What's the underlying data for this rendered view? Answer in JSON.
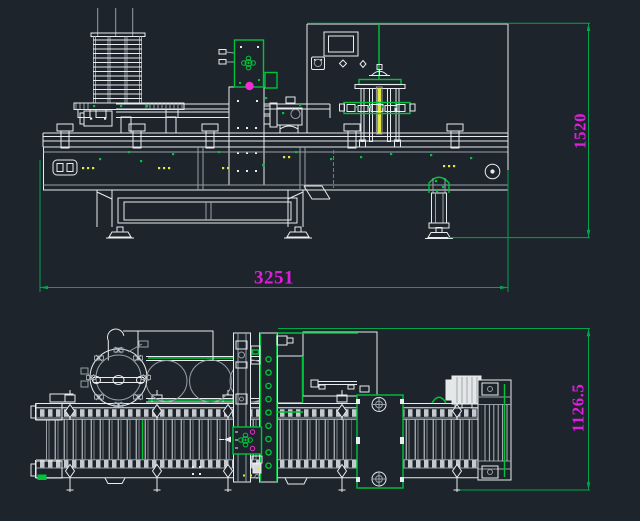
{
  "canvas": {
    "width": 640,
    "height": 521,
    "background": "#1D242B"
  },
  "palette": {
    "line_white": "#E9ECEE",
    "line_gray": "#97A0A8",
    "green_dim": "#00A54E",
    "green_accent": "#00C43B",
    "magenta_text": "#DF1EDF",
    "magenta_fill": "#F32BD5",
    "yellow": "#E3E83B",
    "cyan": "#12A2AA",
    "metal_fill": "#E4E6E7"
  },
  "views": {
    "front": {
      "dimensions": {
        "width": {
          "label": "3251"
        },
        "height": {
          "label": "1520"
        }
      }
    },
    "plan": {
      "dimensions": {
        "depth": {
          "label": "1126.5"
        }
      }
    }
  }
}
